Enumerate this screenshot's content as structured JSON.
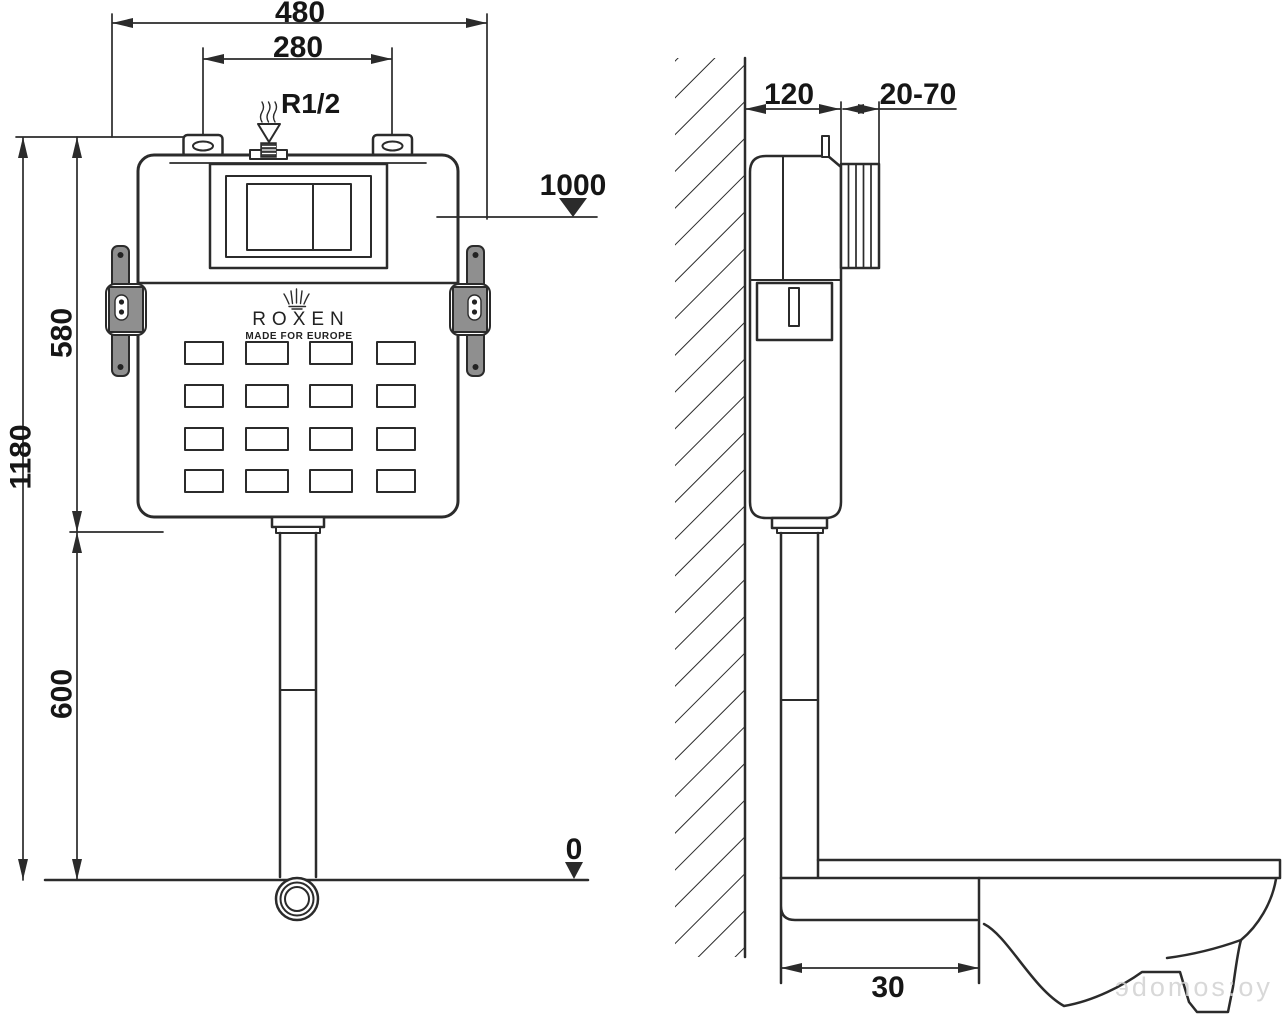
{
  "brand": {
    "name": "ROXEN",
    "tagline": "MADE FOR EUROPE"
  },
  "front_view": {
    "labels": {
      "overall_width": "480",
      "mount_spacing": "280",
      "inlet_thread": "R1/2",
      "supply_height": "1000",
      "total_height": "1180",
      "tank_height": "580",
      "pipe_height": "600",
      "zero_level": "0"
    }
  },
  "side_view": {
    "labels": {
      "depth": "120",
      "faceplate_range": "20-70",
      "outlet_offset": "30"
    }
  },
  "watermark": "эdomos:oy",
  "colors": {
    "line": "#2b2b2b",
    "bracket": "#8f8f8f",
    "watermark": "#d2d2d2",
    "bg": "#ffffff"
  }
}
